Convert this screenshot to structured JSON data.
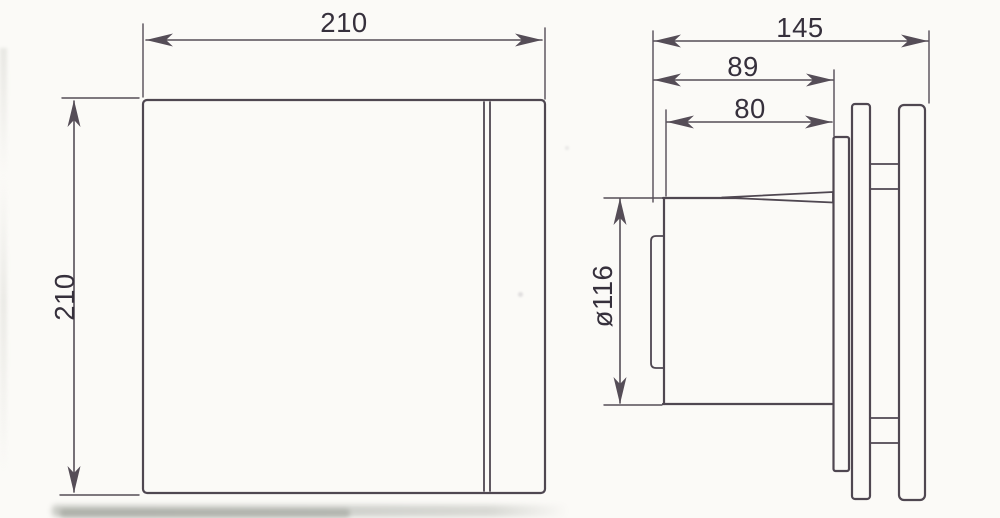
{
  "drawing": {
    "description": "extractor fan dimensional drawing, front and side views",
    "front_view": {
      "width_label": "210",
      "height_label": "210"
    },
    "side_view": {
      "overall_depth_label": "145",
      "depth_to_mounting_plate_label": "89",
      "body_depth_label": "80",
      "body_diameter_label": "ø116"
    },
    "colors": {
      "line-color": "#4f4751",
      "dim-color": "#554d57",
      "text-color": "#36303c",
      "paper-color": "#fbfaf7"
    }
  }
}
